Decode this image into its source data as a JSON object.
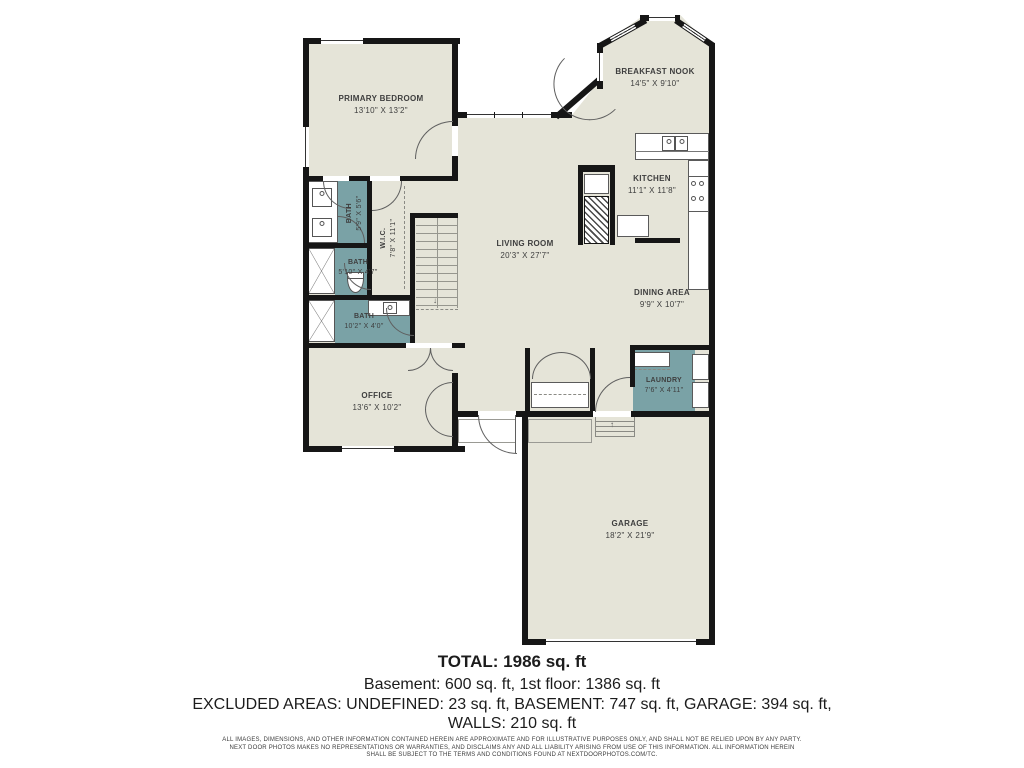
{
  "plan": {
    "colors": {
      "floor": "#e5e4d8",
      "bath_fill": "#7aa2a6",
      "wall": "#161616"
    },
    "rooms": {
      "primary_bedroom": {
        "name": "PRIMARY BEDROOM",
        "dims": "13'10\" X 13'2\""
      },
      "breakfast_nook": {
        "name": "BREAKFAST NOOK",
        "dims": "14'5\" X 9'10\""
      },
      "kitchen": {
        "name": "KITCHEN",
        "dims": "11'1\" X 11'8\""
      },
      "living_room": {
        "name": "LIVING ROOM",
        "dims": "20'3\" X 27'7\""
      },
      "dining_area": {
        "name": "DINING AREA",
        "dims": "9'9\" X 10'7\""
      },
      "laundry": {
        "name": "LAUNDRY",
        "dims": "7'6\" X 4'11\""
      },
      "office": {
        "name": "OFFICE",
        "dims": "13'6\" X 10'2\""
      },
      "garage": {
        "name": "GARAGE",
        "dims": "18'2\" X 21'9\""
      },
      "bath_primary": {
        "name": "BATH",
        "dims": "5'9\" X 5'6\""
      },
      "bath_middle": {
        "name": "BATH",
        "dims": "5'10\" X 4'7\""
      },
      "bath_hall": {
        "name": "BATH",
        "dims": "10'2\" X 4'0\""
      },
      "wic": {
        "name": "W.I.C.",
        "dims": "7'8\" X 11'1\""
      }
    }
  },
  "summary": {
    "total": "TOTAL: 1986 sq. ft",
    "line2": "Basement: 600 sq. ft, 1st floor: 1386 sq. ft",
    "line3": "EXCLUDED AREAS: UNDEFINED: 23 sq. ft, BASEMENT: 747 sq. ft, GARAGE: 394 sq. ft,",
    "line4": "WALLS: 210 sq. ft"
  },
  "disclaimer": {
    "line1": "ALL IMAGES, DIMENSIONS, AND OTHER INFORMATION CONTAINED HEREIN ARE APPROXIMATE AND FOR ILLUSTRATIVE PURPOSES ONLY, AND SHALL NOT BE RELIED UPON BY ANY PARTY.",
    "line2": "NEXT DOOR PHOTOS MAKES NO REPRESENTATIONS OR WARRANTIES, AND DISCLAIMS ANY AND ALL LIABILITY ARISING FROM USE OF THIS INFORMATION. ALL INFORMATION HEREIN",
    "line3": "SHALL BE SUBJECT TO THE TERMS AND CONDITIONS FOUND AT NEXTDOORPHOTOS.COM/TC."
  }
}
